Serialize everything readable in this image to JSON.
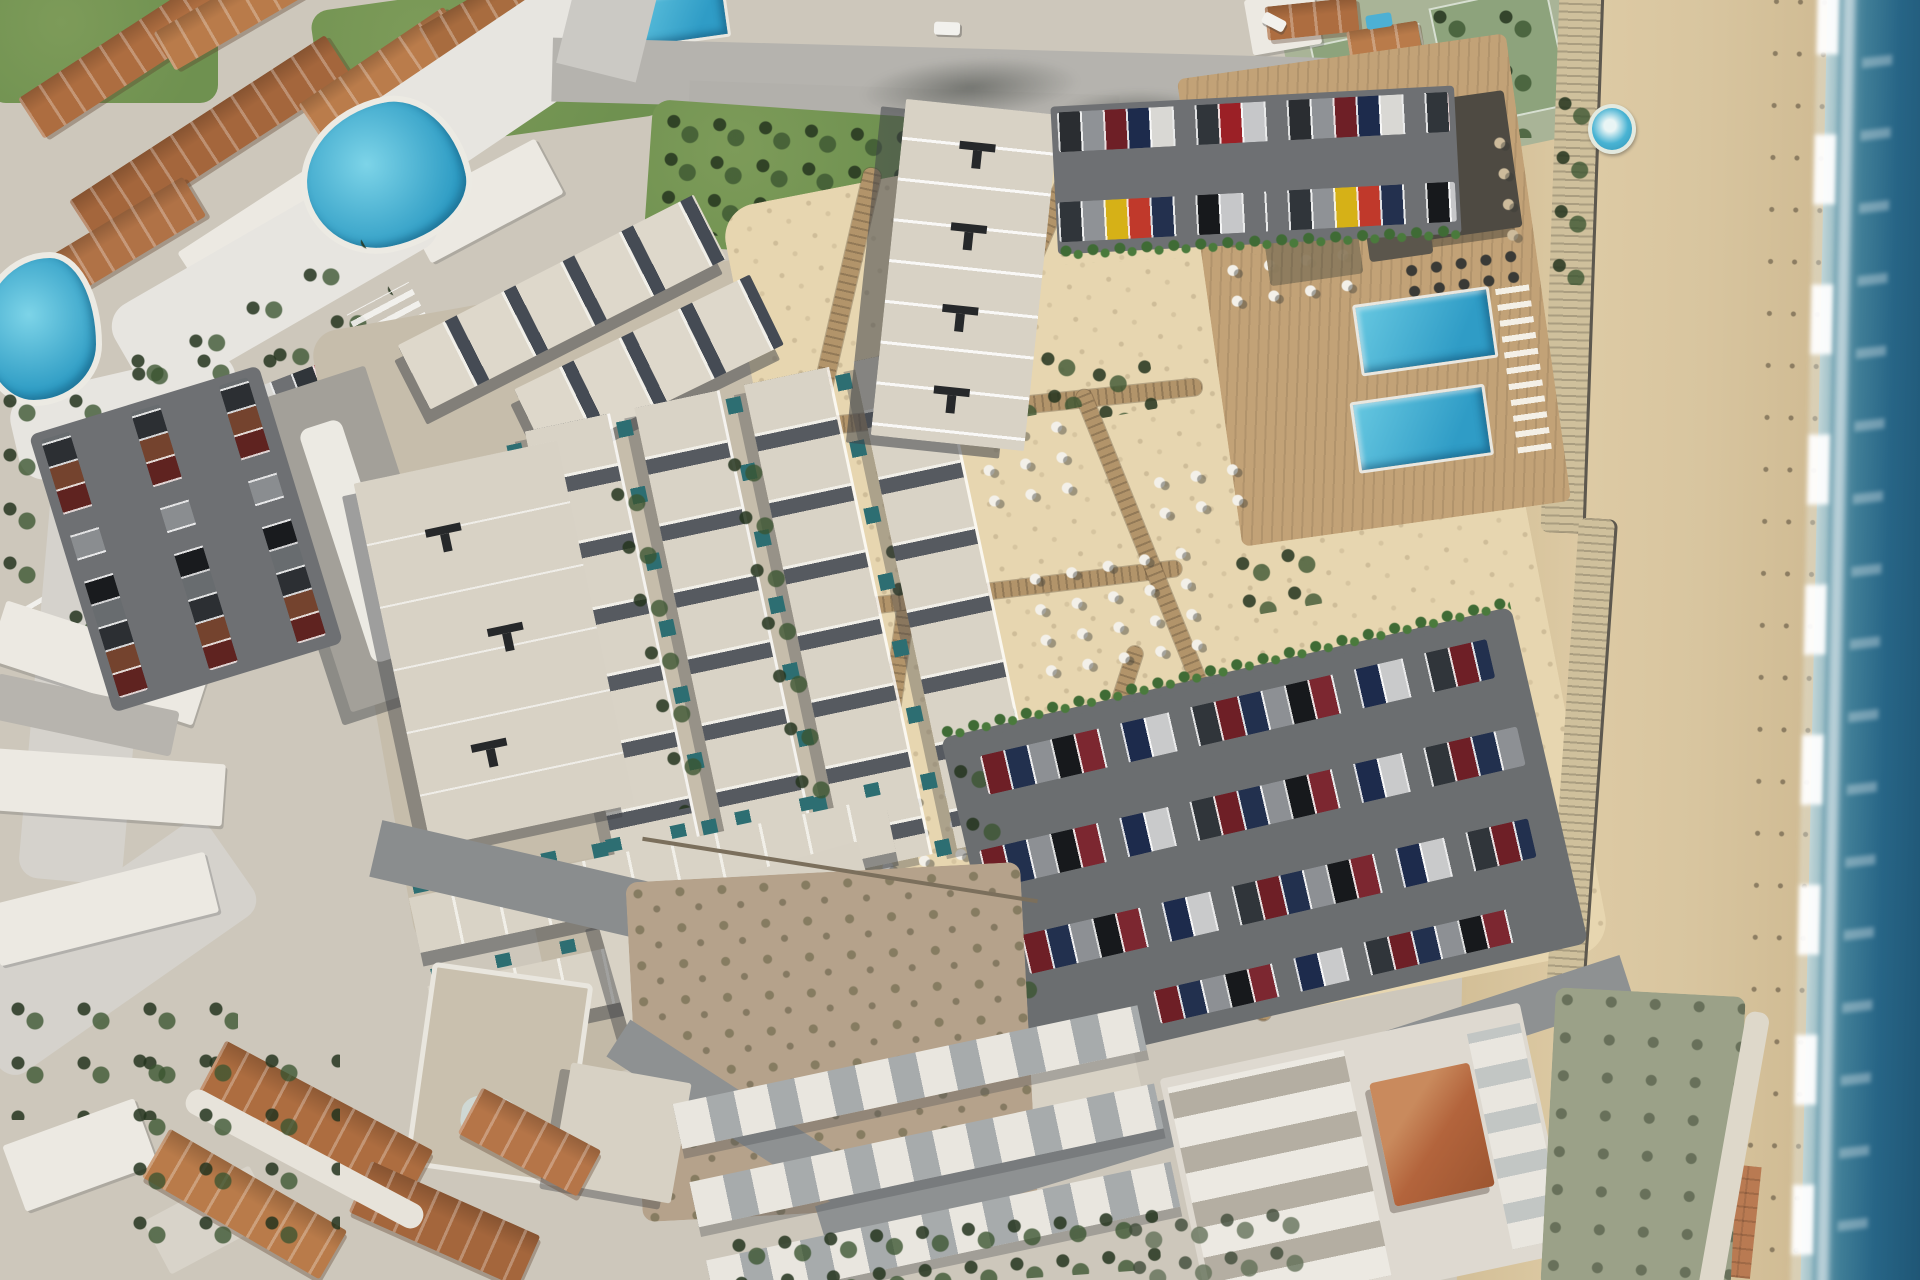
{
  "scene": {
    "description": "Top-down aerial rendering of a new beachfront resort development composited onto satellite imagery: grids of flat-roofed townhouses with small teal plunge pools, a cream sand garden crossed by timber boardwalks with clusters of white parasols, a timber pool deck with two rectangular blue pools and a dark-roofed beach club, car-filled parking lots, an existing villa neighbourhood with curving white streets, terracotta roofs and lagoon pools to the north-west, white apartment rows to the south, and a wide sandy beach meeting the surf along the east edge.",
    "view": "orthographic aerial, daytime"
  },
  "palette": {
    "base_ground": "#cdc7bb",
    "sea_deep": "#1d5271",
    "sea_mid": "#2e6d8a",
    "sea_shallow": "#7fb0bd",
    "surf_foam": "#f2f6f4",
    "wet_sand": "#a3927b",
    "beach_sand": "#d9c7a2",
    "garden_sand": "#e7d6b0",
    "boardwalk_timber": "#b2946a",
    "deck_timber": "#c2a277",
    "pool_water": "#2f9cc6",
    "pool_water_light": "#67c8e1",
    "plunge_pool": "#2d6e72",
    "roof_light": "#d8d2c5",
    "roof_ridge": "#f1efe8",
    "hard_shadow": "#4b4e52",
    "roof_vent": "#26282a",
    "asphalt": "#6e7073",
    "road": "#b5b3ae",
    "street_white": "#e7e5e0",
    "dirt": "#c6bdab",
    "vacant_lot": "#b5a28b",
    "lawn": "#6f9150",
    "hedge": "#3f6b35",
    "terracotta_roof": "#ad6d40",
    "white_building": "#ece9e2",
    "parasol": "#f3f0e9",
    "beach_club_roof": "#4e4a42",
    "blue_parasol": "#2d66c8",
    "car_colors": [
      "#6e1f26",
      "#22304e",
      "#8d9094",
      "#17191c",
      "#c0392b",
      "#d6b117",
      "#c9cacb",
      "#30353a"
    ]
  },
  "features": {
    "main_pools_count": 2,
    "spa_pool_count": 1,
    "townhouse_plunge_pools": "rows of small teal plunge pools between townhouse units",
    "parking_lots_count": 3,
    "boardwalk_network": "winding timber paths across the sand garden",
    "parasol_clusters_count": 8,
    "beach": "wide sandy beach with a surf line along the east edge",
    "neighbourhood": "existing villas with terracotta roofs, lagoon pools and white curving streets"
  }
}
